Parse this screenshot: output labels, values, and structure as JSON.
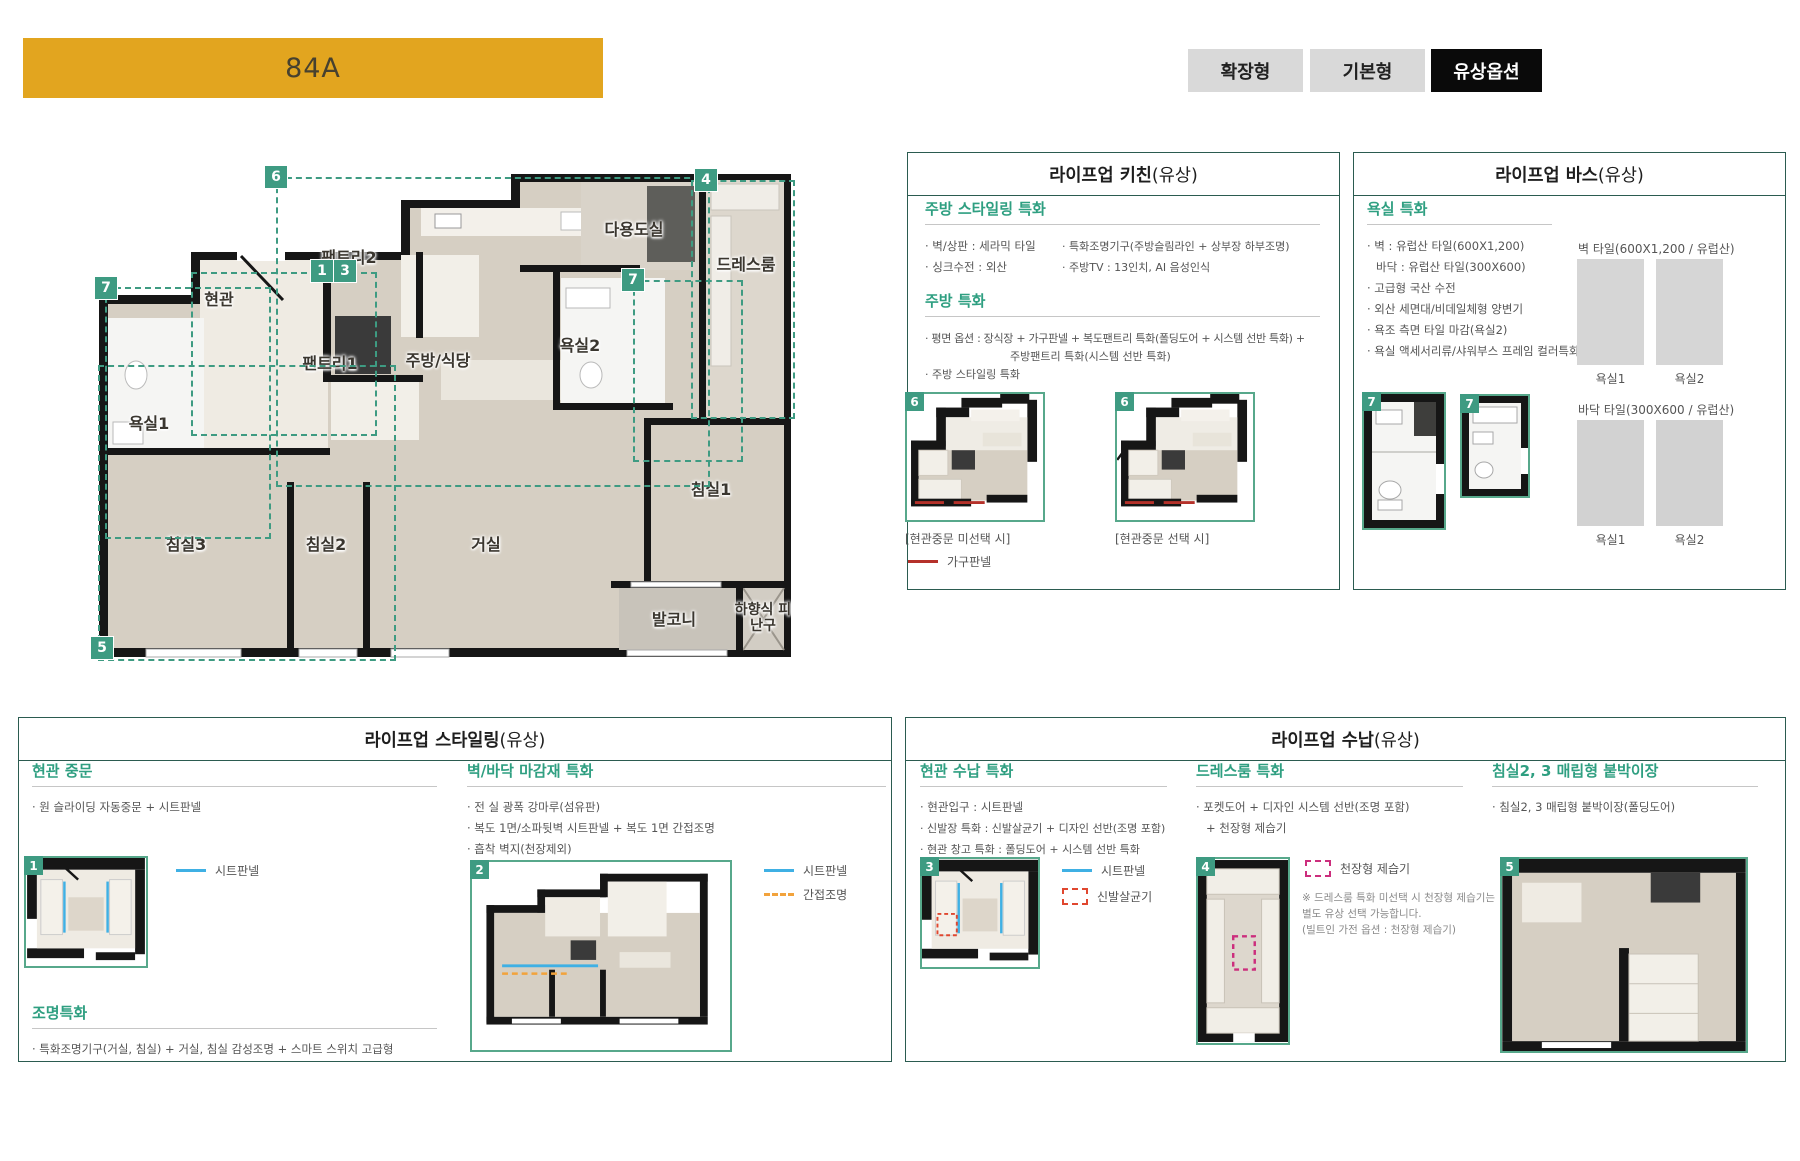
{
  "banner": {
    "label": "84A",
    "bg": "#e2a51f"
  },
  "toolbar": {
    "buttons": [
      {
        "label": "확장형",
        "selected": false
      },
      {
        "label": "기본형",
        "selected": false
      },
      {
        "label": "유상옵션",
        "selected": true
      }
    ]
  },
  "plan": {
    "rooms": [
      {
        "label": "현관"
      },
      {
        "label": "팬트리2"
      },
      {
        "label": "팬트리1"
      },
      {
        "label": "주방/식당"
      },
      {
        "label": "다용도실"
      },
      {
        "label": "욕실2"
      },
      {
        "label": "드레스룸"
      },
      {
        "label": "욕실1"
      },
      {
        "label": "침실3"
      },
      {
        "label": "침실2"
      },
      {
        "label": "거실"
      },
      {
        "label": "침실1"
      },
      {
        "label": "발코니"
      },
      {
        "label": "하향식 피난구"
      }
    ],
    "badges": [
      {
        "n": "6"
      },
      {
        "n": "4"
      },
      {
        "n": "1"
      },
      {
        "n": "3"
      },
      {
        "n": "7"
      },
      {
        "n": "7"
      },
      {
        "n": "5"
      }
    ]
  },
  "kitchen": {
    "title": "라이프업 키친",
    "suffix": "(유상)",
    "s1": {
      "heading": "주방 스타일링 특화",
      "col1": [
        "· 벽/상판 : 세라믹 타일",
        "· 싱크수전 : 외산"
      ],
      "col2": [
        "· 특화조명기구(주방슬림라인 + 상부장 하부조명)",
        "· 주방TV : 13인치, AI 음성인식"
      ]
    },
    "s2": {
      "heading": "주방 특화",
      "lines": [
        "· 평면 옵션 : 장식장 + 가구판넬 + 복도팬트리 특화(폴딩도어 + 시스템 선반 특화) +",
        "주방팬트리 특화(시스템 선반 특화)",
        "· 주방 스타일링 특화"
      ]
    },
    "thumbs": [
      {
        "badge": "6",
        "caption": "[현관중문 미선택 시]"
      },
      {
        "badge": "6",
        "caption": "[현관중문 선택 시]"
      }
    ],
    "legend": {
      "label": "가구판넬",
      "color": "#b5312a"
    }
  },
  "bath": {
    "title": "라이프업 바스",
    "suffix": "(유상)",
    "heading": "욕실 특화",
    "lines": [
      "· 벽 : 유럽산 타일(600X1,200)",
      "바닥 : 유럽산 타일(300X600)",
      "· 고급형 국산 수전",
      "· 외산 세면대/비데일체형 양변기",
      "· 욕조 측면 타일 마감(욕실2)",
      "· 욕실 액세서리류/샤워부스 프레임 컬러특화"
    ],
    "thumbs": [
      {
        "badge": "7"
      },
      {
        "badge": "7"
      }
    ],
    "wall_tiles": {
      "caption": "벽 타일(600X1,200 / 유럽산)",
      "labels": [
        "욕실1",
        "욕실2"
      ]
    },
    "floor_tiles": {
      "caption": "바닥 타일(300X600 / 유럽산)",
      "labels": [
        "욕실1",
        "욕실2"
      ]
    }
  },
  "styling": {
    "title": "라이프업 스타일링",
    "suffix": "(유상)",
    "door": {
      "heading": "현관 중문",
      "lines": [
        "· 원 슬라이딩 자동중문 + 시트판넬"
      ],
      "badge": "1",
      "legend": [
        {
          "label": "시트판넬",
          "color": "#3fb0e4"
        }
      ]
    },
    "light": {
      "heading": "조명특화",
      "lines": [
        "· 특화조명기구(거실, 침실) + 거실, 침실 감성조명 + 스마트 스위치 고급형"
      ]
    },
    "finish": {
      "heading": "벽/바닥 마감재 특화",
      "lines": [
        "· 전 실 광폭 강마루(섬유판)",
        "· 복도 1면/소파뒷벽 시트판넬 + 복도 1면 간접조명",
        "· 흡착 벽지(천장제외)"
      ],
      "badge": "2",
      "legend": [
        {
          "label": "시트판넬",
          "color": "#3fb0e4"
        },
        {
          "label": "간접조명",
          "color": "#f2a33c"
        }
      ]
    }
  },
  "storage": {
    "title": "라이프업 수납",
    "suffix": "(유상)",
    "entrance": {
      "heading": "현관 수납 특화",
      "lines": [
        "· 현관입구 : 시트판넬",
        "· 신발장 특화 : 신발살균기 + 디자인 선반(조명 포함)",
        "· 현관 창고 특화 : 폴딩도어 + 시스템 선반 특화"
      ],
      "badge": "3",
      "legend": [
        {
          "label": "시트판넬",
          "color": "#3fb0e4"
        },
        {
          "label": "신발살균기",
          "color": "#e0472f"
        }
      ]
    },
    "dress": {
      "heading": "드레스룸 특화",
      "lines": [
        "· 포켓도어 + 디자인 시스템 선반(조명 포함)",
        "+ 천장형 제습기"
      ],
      "badge": "4",
      "legend": [
        {
          "label": "천장형 제습기",
          "color": "#cc2e7d"
        }
      ],
      "note": [
        "※ 드레스룸 특화 미선택 시 천장형 제습기는",
        "별도 유상 선택 가능합니다.",
        "(빌트인 가전 옵션 : 천장형 제습기)"
      ]
    },
    "bed": {
      "heading": "침실2, 3 매립형 붙박이장",
      "lines": [
        "· 침실2, 3 매립형 붙박이장(폴딩도어)"
      ],
      "badge": "5"
    }
  }
}
